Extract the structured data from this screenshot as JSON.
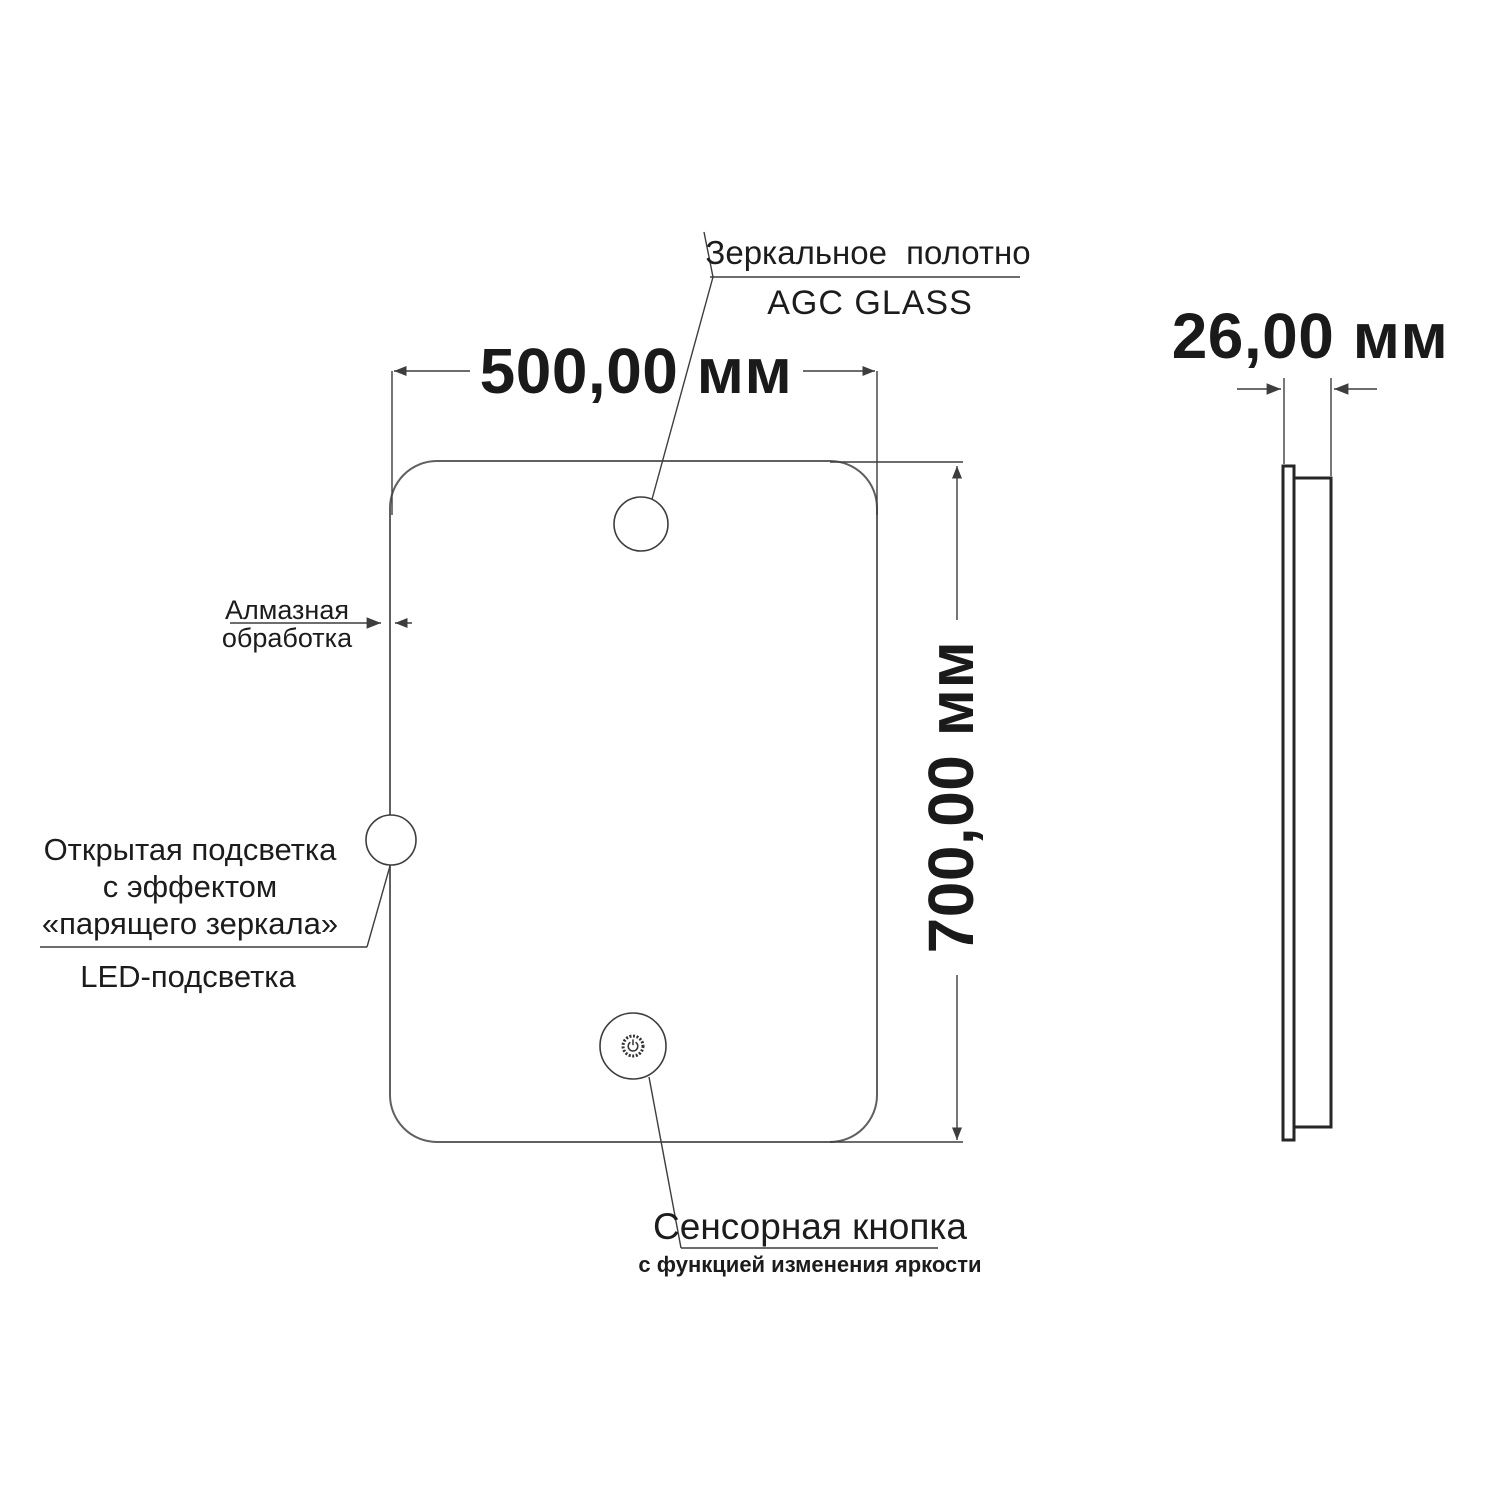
{
  "drawing": {
    "front_view": {
      "canvas_label_line1": "Зеркальное полотно",
      "canvas_label_line2": "AGC GLASS",
      "width_dimension": "500,00 мм",
      "height_dimension": "700,00 мм",
      "edge_label_line1": "Алмазная",
      "edge_label_line2": "обработка",
      "backlight_label_line1": "Открытая подсветка",
      "backlight_label_line2": "с эффектом",
      "backlight_label_line3": "«парящего зеркала»",
      "led_label": "LED-подсветка",
      "touch_label": "Сенсорная кнопка",
      "touch_sublabel": "с функцией изменения яркости"
    },
    "side_view": {
      "depth_dimension": "26,00 мм"
    },
    "colors": {
      "background": "#ffffff",
      "text": "#1c1c1c",
      "dimension_text": "#1a1a1a",
      "mirror_outline": "#606060",
      "dimension_lines": "#3d3d3d",
      "side_view_outline": "#262626"
    }
  }
}
